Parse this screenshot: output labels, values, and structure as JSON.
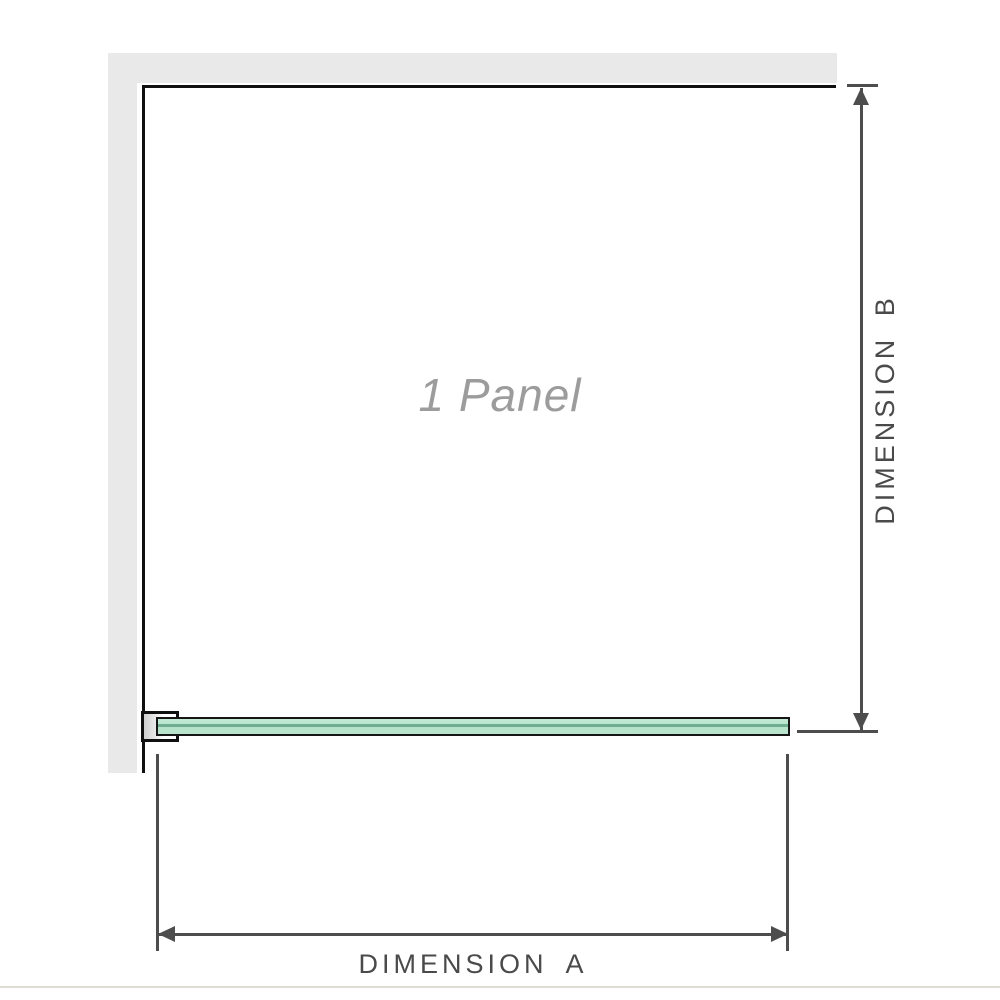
{
  "diagram": {
    "panel_label": "1 Panel",
    "dimension_a": {
      "label": "DIMENSION A"
    },
    "dimension_b": {
      "label": "DIMENSION B"
    }
  },
  "colors": {
    "wall_fill": "#e9e9e9",
    "wall_line": "#101010",
    "glass_border": "#161616",
    "glass_stripe": "#6fae91",
    "dimension_line": "#4d4d4d",
    "label_text": "#4a4a4a",
    "panel_text": "#9c9c9c",
    "divider": "#dedcd4"
  }
}
